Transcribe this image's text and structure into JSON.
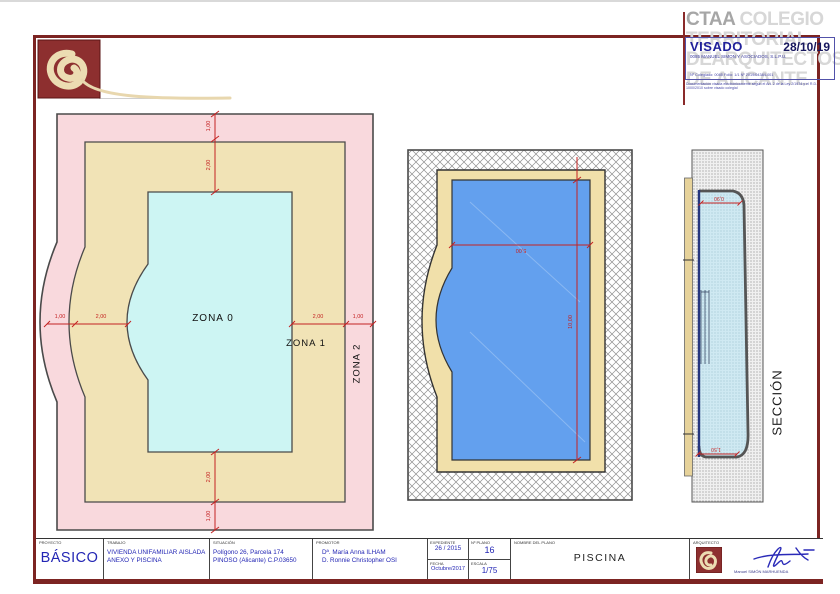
{
  "sheet": {
    "stamp": {
      "org_name_bold": "CTAA",
      "org_line1_rest": "COLEGIO",
      "org_line2": "TERRITORIAL",
      "org_line3": "DEARQUITECTOS",
      "org_line4": "DE ALICANTE",
      "visado_label": "VISADO",
      "visado_date": "28/10/19",
      "firm_line": "0085 MANUEL SIMON Y ASOCIADOS, S.L.P.U.",
      "ref_line": "Nº Colegiado: 0085     Folio: 1/1     Nº 2019/04384-001",
      "legal_line": "Documentación visada electrónicamente según el Art. 2 de la Ley 2/1974 y el R.D. 1000/2010 sobre visado colegial"
    },
    "plan": {
      "zone0": "ZONA 0",
      "zone1": "ZONA 1",
      "zone2": "ZONA 2",
      "dim_top_outer": "1,00",
      "dim_top_inner": "2,00",
      "dim_bottom_inner": "2,00",
      "dim_bottom_outer": "1,00",
      "dim_left_outer": "1,00",
      "dim_left_inner": "2,00",
      "dim_right_inner": "2,00",
      "dim_right_outer": "1,00"
    },
    "pool": {
      "dim_width": "5,00",
      "dim_length": "10,00"
    },
    "section": {
      "label": "SECCIÓN",
      "dim_top": "0,90",
      "dim_bottom": "1,50"
    },
    "colors": {
      "frame": "#7c2422",
      "zone_outer_pink": "#f9d9dd",
      "zone_mid_tan": "#f1e3b6",
      "zone_pool_cyan": "#cdf5f3",
      "pool_water_blue": "#63a0ee",
      "dim_red": "#c42222",
      "title_blue": "#2326b4"
    },
    "titleblock": {
      "proyecto": {
        "header": "PROYECTO",
        "value": "BÁSICO"
      },
      "trabajo": {
        "header": "TRABAJO",
        "line1": "VIVIENDA UNIFAMILIAR  AISLADA",
        "line2": "ANEXO Y PISCINA"
      },
      "situacion": {
        "header": "SITUACIÓN",
        "line1": "Polígono 26,  Parcela 174",
        "line2": "PINOSO (Alicante) C.P.03650"
      },
      "promotor": {
        "header": "PROMOTOR",
        "line1": "Dª. María Anna ILHAM",
        "line2": "D. Ronnie Christopher OSI"
      },
      "expediente": {
        "header": "EXPEDIENTE",
        "value": "26 / 2015"
      },
      "num_plano": {
        "header": "Nº PLANO",
        "value": "16"
      },
      "fecha": {
        "header": "FECHA",
        "value": "Octubre/2017"
      },
      "escala": {
        "header": "ESCALA",
        "value": "1/75"
      },
      "nombre": {
        "header": "NOMBRE DEL PLANO",
        "value": "PISCINA"
      },
      "arquitecto": {
        "header": "ARQUITECTO",
        "value": "Manuel SIMÓN MARHUENDA"
      }
    }
  }
}
